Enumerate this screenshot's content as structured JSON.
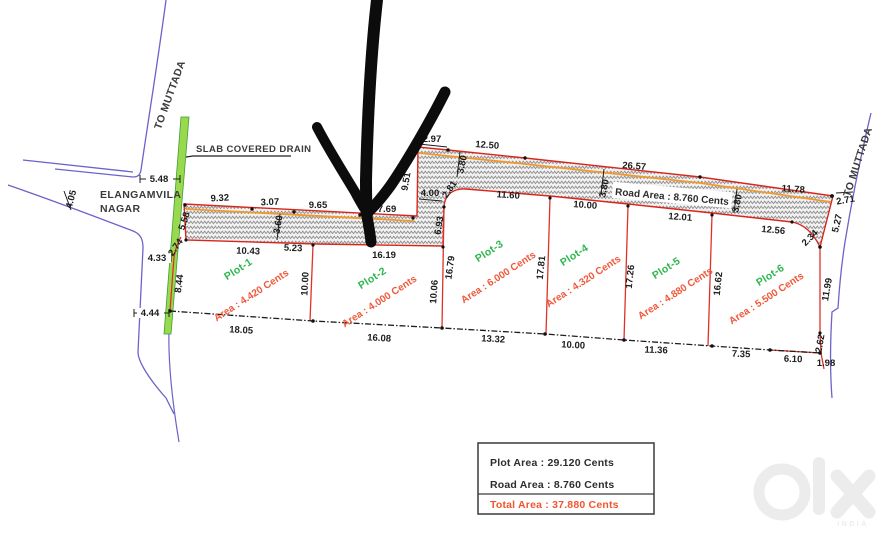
{
  "labels": {
    "to_muttada_left": "TO MUTTADA",
    "to_muttada_right": "TO MUTTADA",
    "locality_line1": "ELANGAMVILA",
    "locality_line2": "NAGAR",
    "drain_label": "SLAB COVERED DRAIN",
    "road_area_label": "Road Area : 8.760 Cents"
  },
  "plots": [
    {
      "name": "Plot-1",
      "area": "Area : 4.420 Cents"
    },
    {
      "name": "Plot-2",
      "area": "Area : 4.000 Cents"
    },
    {
      "name": "Plot-3",
      "area": "Area : 6.000 Cents"
    },
    {
      "name": "Plot-4",
      "area": "Area : 4.320 Cents"
    },
    {
      "name": "Plot-5",
      "area": "Area : 4.880 Cents"
    },
    {
      "name": "Plot-6",
      "area": "Area : 5.500 Cents"
    }
  ],
  "dims": [
    "5.48",
    "4.05",
    "4.33",
    "4.44",
    "9.32",
    "3.07",
    "9.65",
    "7.69",
    "5.58",
    "2.74",
    "3.60",
    "10.43",
    "5.23",
    "16.19",
    "8.44",
    "10.00",
    "18.05",
    "16.08",
    "2.97",
    "12.50",
    "9.51",
    "4.00",
    "2.81",
    "3.80",
    "6.93",
    "11.60",
    "26.57",
    "3.80",
    "10.00",
    "12.01",
    "3.80",
    "11.78",
    "2.71",
    "5.27",
    "2.34",
    "12.56",
    "16.79",
    "10.06",
    "17.81",
    "17.26",
    "16.62",
    "11.99",
    "13.32",
    "10.00",
    "11.36",
    "7.35",
    "6.10",
    "2.62",
    "1.98"
  ],
  "legend": {
    "plot_area": "Plot Area : 29.120 Cents",
    "road_area": "Road Area : 8.760 Cents",
    "total_area": "Total Area : 37.880 Cents"
  },
  "watermark": {
    "brand": "olx",
    "country": "INDIA"
  },
  "colors": {
    "plot_line": "#e03127",
    "road_edge": "#d9261c",
    "road_inner_edge": "#f2992e",
    "plot_name_green": "#2eb64f",
    "area_text_orange": "#f0583a",
    "total_area_text": "#f0552f",
    "drain_green": "#98d94e",
    "road_blue": "#6b63c9",
    "marker_black": "#0c0c0c"
  }
}
